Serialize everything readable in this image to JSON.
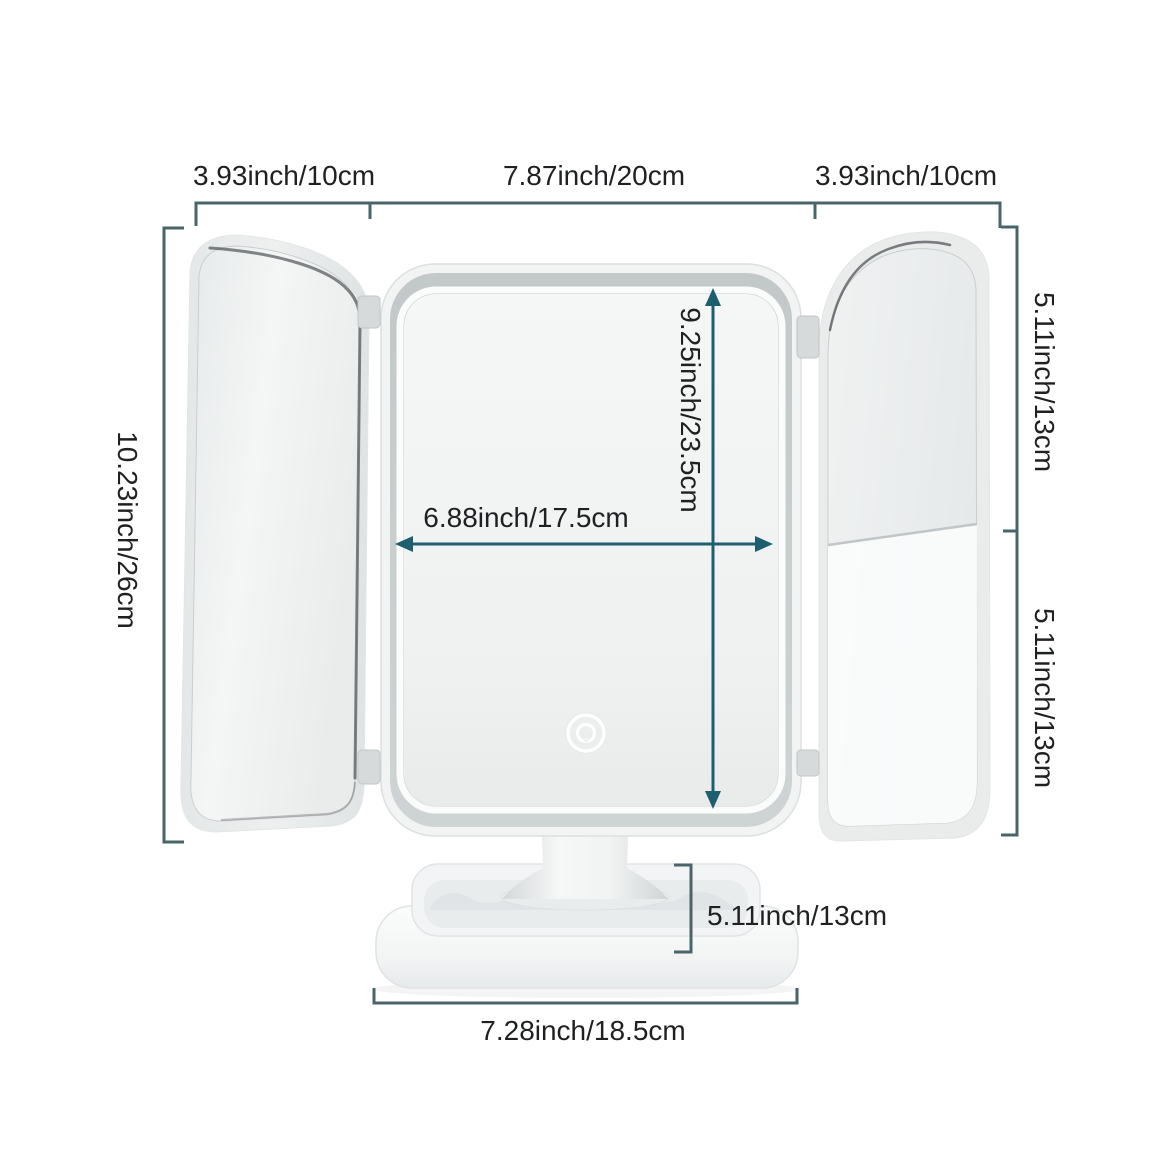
{
  "page": {
    "background": "#ffffff"
  },
  "colors": {
    "dimension_line": "#49656a",
    "arrow": "#1d5f6e",
    "label_text": "#1e2022",
    "frame_gray": "#c7cccd",
    "mirror_face": "#f2f4f4"
  },
  "icons": {
    "touch_sensor": "touch-sensor-icon"
  },
  "dimensions": {
    "top_left_panel_width": "3.93inch/10cm",
    "top_center_width": "7.87inch/20cm",
    "top_right_panel_width": "3.93inch/10cm",
    "overall_height": "10.23inch/26cm",
    "right_upper_height": "5.11inch/13cm",
    "right_lower_height": "5.11inch/13cm",
    "mirror_height": "9.25inch/23.5cm",
    "mirror_width": "6.88inch/17.5cm",
    "base_height": "5.11inch/13cm",
    "base_width": "7.28inch/18.5cm"
  }
}
